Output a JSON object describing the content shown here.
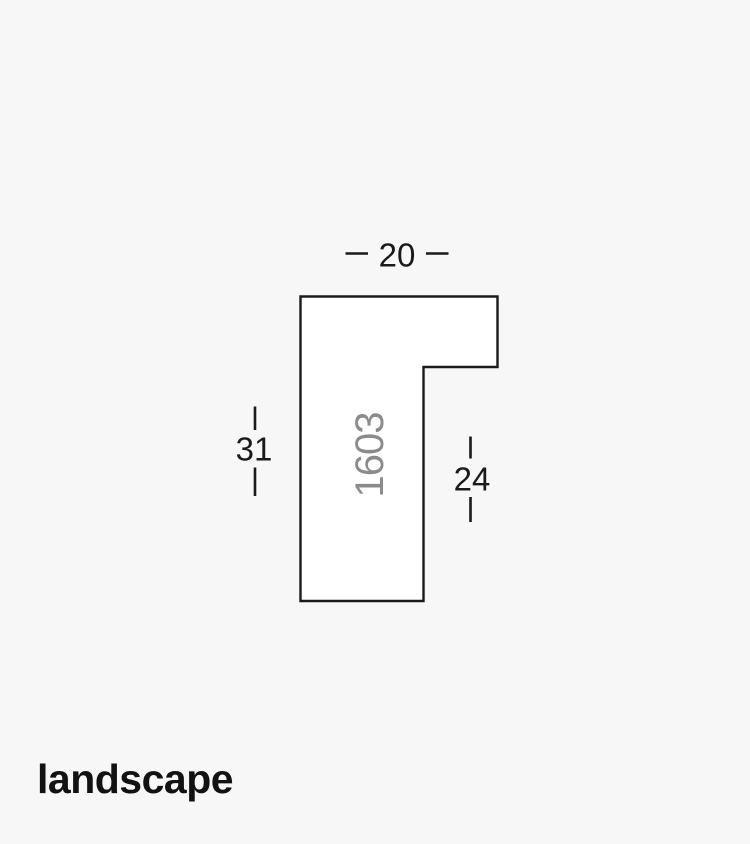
{
  "page": {
    "background_color": "#f7f7f7"
  },
  "colors": {
    "line": "#1a1a1a",
    "shape_fill": "#ffffff",
    "dimension_text": "#1a1a1a",
    "profile_code_text": "#8b8b8b",
    "caption_text": "#121212"
  },
  "profile": {
    "code": "1603"
  },
  "dimensions": {
    "width": "20",
    "height": "31",
    "rebate": "24"
  },
  "caption": {
    "text": "landscape"
  }
}
